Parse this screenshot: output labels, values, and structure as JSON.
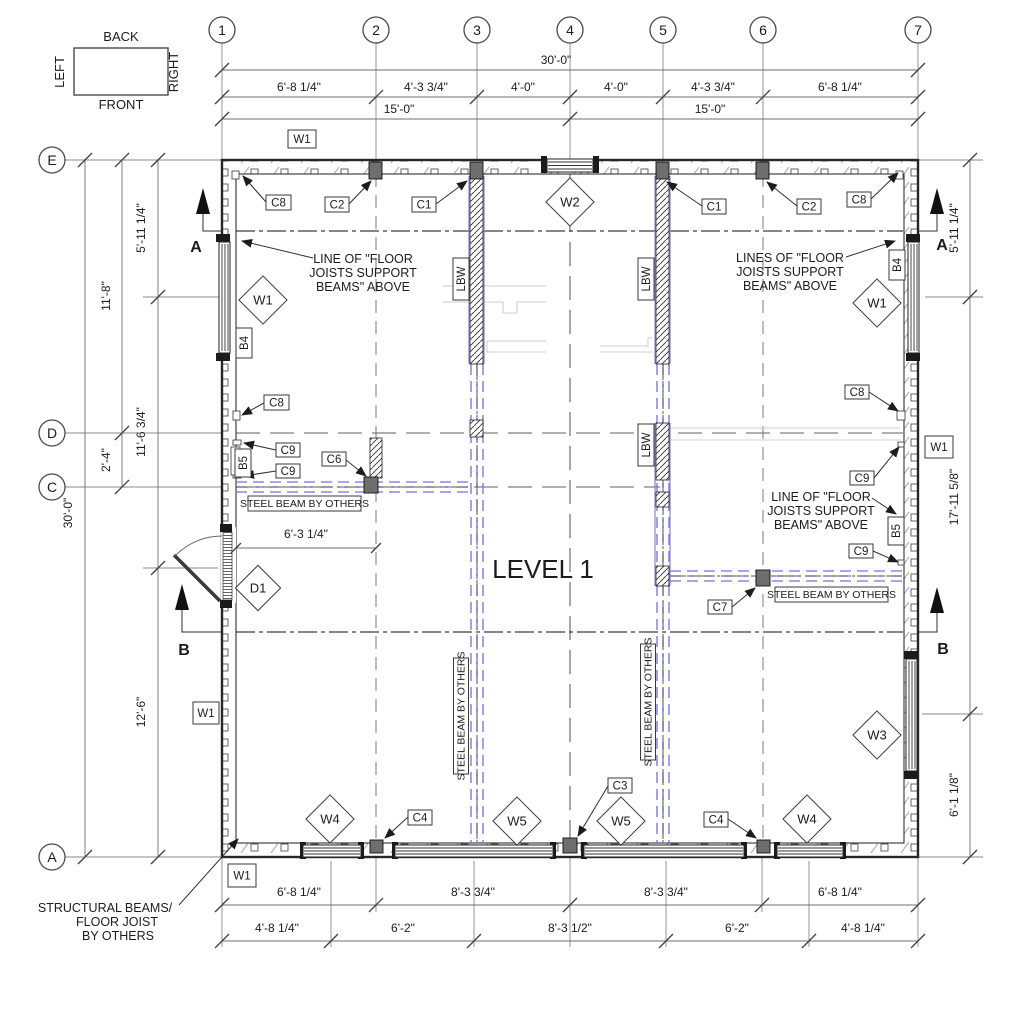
{
  "title": "LEVEL 1",
  "orientation_key": {
    "back": "BACK",
    "left": "LEFT",
    "right": "RIGHT",
    "front": "FRONT"
  },
  "grid_bubbles": {
    "cols": [
      "1",
      "2",
      "3",
      "4",
      "5",
      "6",
      "7"
    ],
    "rows": [
      "E",
      "D",
      "C",
      "A"
    ]
  },
  "dims": {
    "overall_h": "30'-0\"",
    "overall_v": "30'-0\"",
    "top_segs": [
      "6'-8 1/4\"",
      "4'-3 3/4\"",
      "4'-0\"",
      "4'-0\"",
      "4'-3 3/4\"",
      "6'-8 1/4\""
    ],
    "top_halves": [
      "15'-0\"",
      "15'-0\""
    ],
    "left_outer": [
      "11'-8\"",
      "2'-4\""
    ],
    "left_inner": [
      "5'-11 1/4\"",
      "11'-6 3/4\"",
      "12'-6\""
    ],
    "right": [
      "5'-11 1/4\"",
      "17'-11 5/8\"",
      "6'-1 1/8\""
    ],
    "bottom_row1": [
      "6'-8 1/4\"",
      "8'-3 3/4\"",
      "8'-3 3/4\"",
      "6'-8 1/4\""
    ],
    "bottom_row2": [
      "4'-8 1/4\"",
      "6'-2\"",
      "8'-3 1/2\"",
      "6'-2\"",
      "4'-8 1/4\""
    ],
    "door": "6'-3 1/4\""
  },
  "tags": {
    "w1": "W1",
    "w2": "W2",
    "w3": "W3",
    "w4": "W4",
    "w5": "W5",
    "c1": "C1",
    "c2": "C2",
    "c3": "C3",
    "c4": "C4",
    "c6": "C6",
    "c7": "C7",
    "c8": "C8",
    "c9": "C9",
    "b4": "B4",
    "b5": "B5",
    "lbw": "LBW",
    "d1": "D1"
  },
  "notes": {
    "line_left": [
      "LINE OF \"FLOOR",
      "JOISTS SUPPORT",
      "BEAMS\" ABOVE"
    ],
    "lines_right": [
      "LINES OF \"FLOOR",
      "JOISTS SUPPORT",
      "BEAMS\" ABOVE"
    ],
    "line_mid_right": [
      "LINE OF \"FLOOR",
      "JOISTS SUPPORT",
      "BEAMS\" ABOVE"
    ],
    "steel_beam": "STEEL BEAM BY OTHERS",
    "structural": [
      "STRUCTURAL BEAMS/",
      "FLOOR JOIST",
      "BY OTHERS"
    ]
  },
  "sections": {
    "a": "A",
    "b": "B"
  },
  "colors": {
    "beam_blue": "#7070dd",
    "wall_hatch_blue": "#9a9ae2",
    "line_dark": "#3a3a3a",
    "grid_gray": "#808080",
    "faint_gray": "#cfcfcf"
  }
}
